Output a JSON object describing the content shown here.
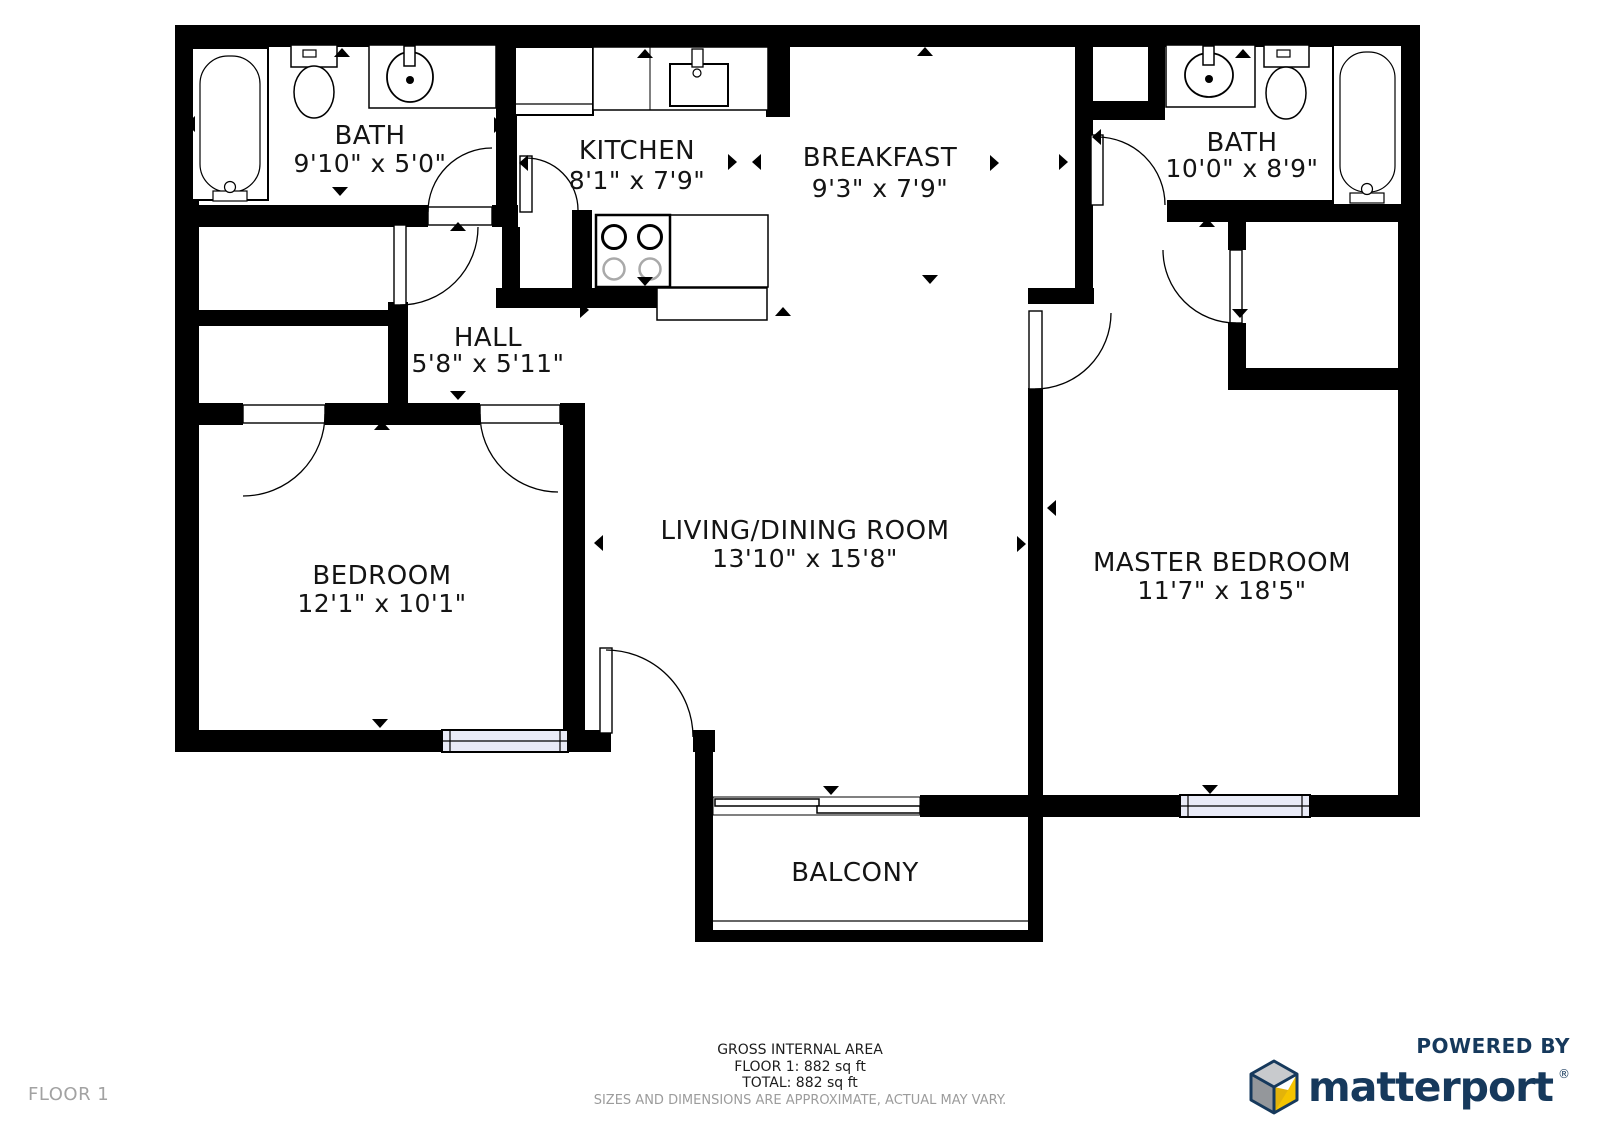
{
  "rooms": {
    "bath1": {
      "name": "BATH",
      "dims": "9'10\" x 5'0\""
    },
    "kitchen": {
      "name": "KITCHEN",
      "dims": "8'1\" x 7'9\""
    },
    "breakfast": {
      "name": "BREAKFAST",
      "dims": "9'3\" x 7'9\""
    },
    "bath2": {
      "name": "BATH",
      "dims": "10'0\" x 8'9\""
    },
    "hall": {
      "name": "HALL",
      "dims": "5'8\" x 5'11\""
    },
    "bedroom": {
      "name": "BEDROOM",
      "dims": "12'1\" x 10'1\""
    },
    "living": {
      "name": "LIVING/DINING ROOM",
      "dims": "13'10\" x 15'8\""
    },
    "master": {
      "name": "MASTER BEDROOM",
      "dims": "11'7\" x 18'5\""
    },
    "balcony": {
      "name": "BALCONY"
    }
  },
  "footer": {
    "gross_area_title": "GROSS INTERNAL AREA",
    "floor_area": "FLOOR 1: 882 sq ft",
    "total_area": "TOTAL: 882 sq ft",
    "disclaimer": "SIZES AND DIMENSIONS ARE APPROXIMATE, ACTUAL MAY VARY."
  },
  "floor_label": "FLOOR 1",
  "branding": {
    "powered_by": "POWERED BY",
    "brand": "matterport",
    "registered_mark": "®"
  },
  "colors": {
    "wall": "#000000",
    "window_fill": "#e9ebf7",
    "brand_navy": "#16395c",
    "brand_yellow": "#f5c400",
    "cube_gray_light": "#c8cacd",
    "cube_gray_dark": "#94979b",
    "muted_text": "#9c9c9c"
  }
}
